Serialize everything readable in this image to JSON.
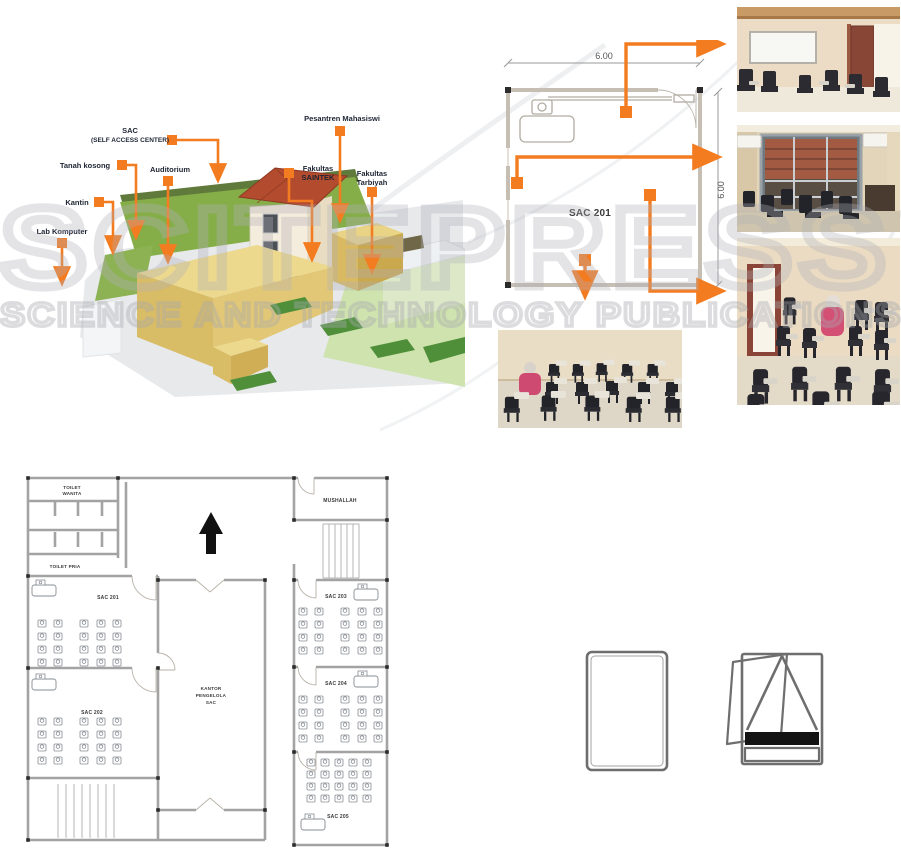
{
  "watermark": {
    "big": "SCITEPRESS",
    "small": "SCIENCE AND TECHNOLOGY PUBLICATIONS"
  },
  "site": {
    "labels": {
      "sac1": "SAC",
      "sac2": "(SELF ACCESS CENTER)",
      "tanah": "Tanah kosong",
      "auditorium": "Auditorium",
      "kantin": "Kantin",
      "lab": "Lab Komputer",
      "pesantren": "Pesantren Mahasiswi",
      "saintek1": "Fakultas",
      "saintek2": "SAINTEK",
      "tarbiyah1": "Fakultas",
      "tarbiyah2": "Tarbiyah"
    }
  },
  "room_plan": {
    "label": "SAC 201",
    "dim_top": "6.00",
    "dim_right": "6.00"
  },
  "floor_plan": {
    "labels": {
      "toilet_w1": "TOILET",
      "toilet_w2": "WANITA",
      "toilet_pria": "TOILET PRIA",
      "sac201": "SAC 201",
      "sac202": "SAC 202",
      "sac203": "SAC 203",
      "sac204": "SAC 204",
      "sac205": "SAC 205",
      "kantor1": "KANTOR",
      "kantor2": "PENGELOLA",
      "kantor3": "SAC",
      "mushallah": "MUSHALLAH"
    }
  },
  "colors": {
    "accent": "#F47C20"
  }
}
